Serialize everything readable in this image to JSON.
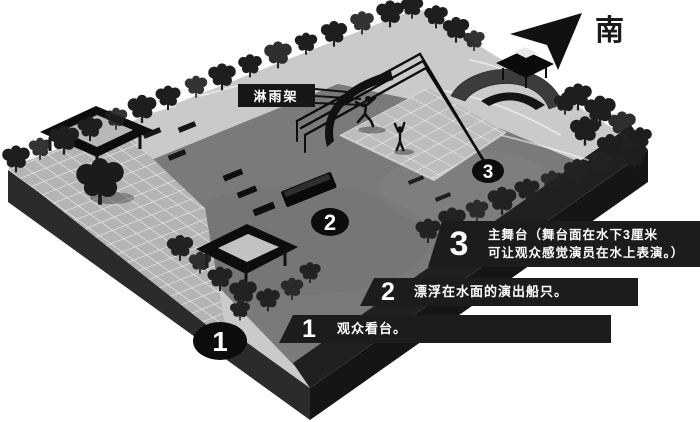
{
  "compass": {
    "label": "南",
    "icon": "south-arrow-icon"
  },
  "labels": {
    "sprinkler_frame": "淋雨架"
  },
  "markers": [
    {
      "num": "1"
    },
    {
      "num": "2"
    },
    {
      "num": "3"
    }
  ],
  "legend": [
    {
      "num": "3",
      "lines": [
        "主舞台（舞台面在水下3厘米",
        "可让观众感觉演员在水上表演。）"
      ]
    },
    {
      "num": "2",
      "lines": [
        "漂浮在水面的演出船只。"
      ]
    },
    {
      "num": "1",
      "lines": [
        "观众看台。"
      ]
    }
  ],
  "colors": {
    "background": "#ffffff",
    "ink": "#141414",
    "water": "#7a7a7a",
    "pavement": "#cacaca",
    "tile": "#b4b4b4",
    "stage": "#bdbdbd",
    "legend_bar": "#1c1c1c",
    "legend_text": "#ffffff"
  }
}
